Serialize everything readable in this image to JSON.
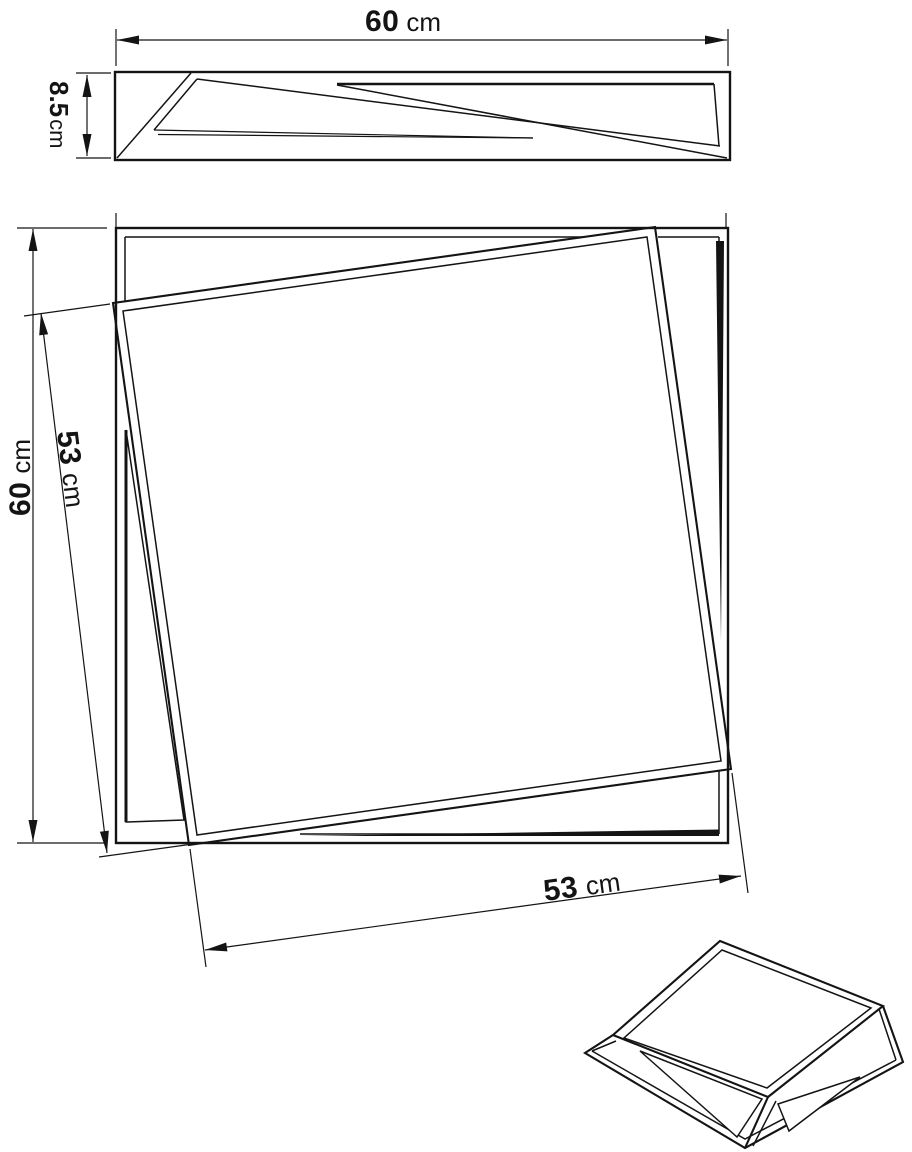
{
  "colors": {
    "ink": "#141414",
    "paper": "#ffffff"
  },
  "dims": {
    "profile_width": {
      "number": "60",
      "unit": "cm"
    },
    "profile_height": {
      "number": "8.5",
      "unit": "cm"
    },
    "plan_side": {
      "number": "60",
      "unit": "cm"
    },
    "inner_side": {
      "number": "53",
      "unit": "cm"
    },
    "inner_bottom": {
      "number": "53",
      "unit": "cm"
    }
  }
}
